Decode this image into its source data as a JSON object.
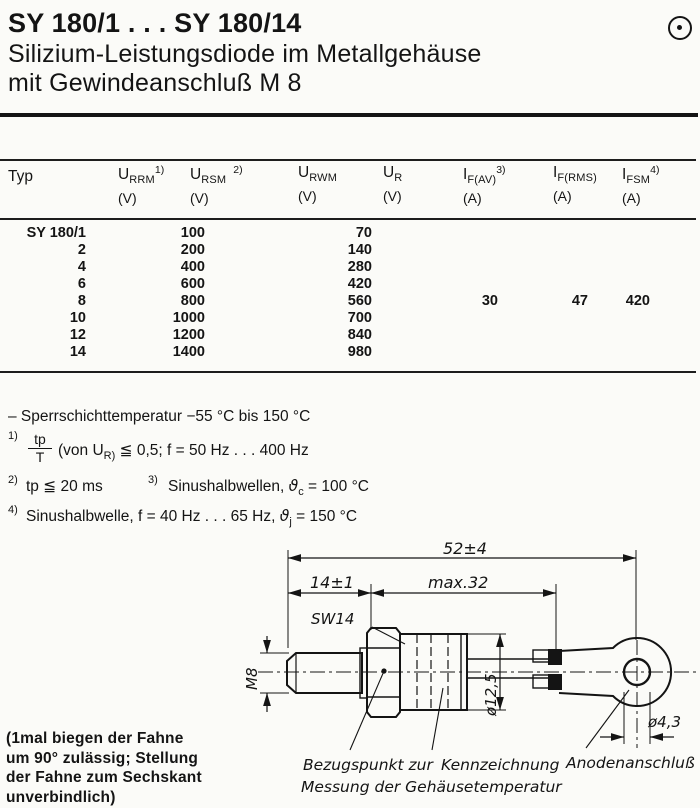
{
  "header": {
    "title": "SY 180/1 . . . SY 180/14",
    "subtitle_line1": "Silizium-Leistungsdiode im Metallgehäuse",
    "subtitle_line2": "mit Gewindeanschluß M 8"
  },
  "table": {
    "columns": [
      {
        "main": "Typ",
        "sub": "",
        "sup": "",
        "unit": ""
      },
      {
        "main": "U",
        "sub": "RRM",
        "sup": "1)",
        "unit": "(V)"
      },
      {
        "main": "U",
        "sub": "RSM",
        "sup": "2)",
        "unit": "(V)"
      },
      {
        "main": "U",
        "sub": "RWM",
        "sup": "",
        "unit": "(V)"
      },
      {
        "main": "U",
        "sub": "R",
        "sup": "",
        "unit": "(V)"
      },
      {
        "main": "I",
        "sub": "F(AV)",
        "sup": "3)",
        "unit": "(A)"
      },
      {
        "main": "I",
        "sub": "F(RMS)",
        "sup": "",
        "unit": "(A)"
      },
      {
        "main": "I",
        "sub": "FSM",
        "sup": "4)",
        "unit": "(A)"
      }
    ],
    "rows": [
      {
        "typ": "SY 180/1",
        "urrm_ursm": "100",
        "urwm": "70"
      },
      {
        "typ": "2",
        "urrm_ursm": "200",
        "urwm": "140"
      },
      {
        "typ": "4",
        "urrm_ursm": "400",
        "urwm": "280"
      },
      {
        "typ": "6",
        "urrm_ursm": "600",
        "urwm": "420"
      },
      {
        "typ": "8",
        "urrm_ursm": "800",
        "urwm": "560"
      },
      {
        "typ": "10",
        "urrm_ursm": "1000",
        "urwm": "700"
      },
      {
        "typ": "12",
        "urrm_ursm": "1200",
        "urwm": "840"
      },
      {
        "typ": "14",
        "urrm_ursm": "1400",
        "urwm": "980"
      }
    ],
    "shared_values": {
      "if_av": "30",
      "if_rms": "47",
      "ifsm": "420"
    }
  },
  "notes": {
    "temp_range": "– Sperrschichttemperatur −55 °C bis 150 °C",
    "fn1": {
      "marker": "1)",
      "frac_num": "tp",
      "frac_den": "T",
      "pre": "(von U",
      "sub": "R)",
      "post": " ≦ 0,5; f = 50 Hz . . . 400 Hz"
    },
    "fn2": {
      "marker": "2)",
      "text": "tp ≦ 20 ms"
    },
    "fn3": {
      "marker": "3)",
      "pre": "Sinushalbwellen, ",
      "theta": "ϑ",
      "sub": "c",
      "post": " = 100 °C"
    },
    "fn4": {
      "marker": "4)",
      "pre": "Sinushalbwelle, f = 40 Hz . . . 65 Hz, ",
      "theta": "ϑ",
      "sub": "j",
      "post": " = 150 °C"
    }
  },
  "drawing": {
    "dims": {
      "overall": "52±4",
      "stud_length": "14±1",
      "body_length": "max.32",
      "hex": "SW14",
      "thread": "M8",
      "body_dia": "ø12,5",
      "hole_dia": "ø4,3"
    },
    "captions": {
      "ref_line1": "Bezugspunkt zur",
      "ref_line2": "Messung der Gehäusetemperatur",
      "marking": "Kennzeichnung",
      "anode": "Anodenanschluß"
    }
  },
  "side_note": {
    "line1": "(1mal biegen der Fahne",
    "line2": "um 90° zulässig; Stellung",
    "line3": "der Fahne zum Sechskant",
    "line4": "unverbindlich)"
  }
}
